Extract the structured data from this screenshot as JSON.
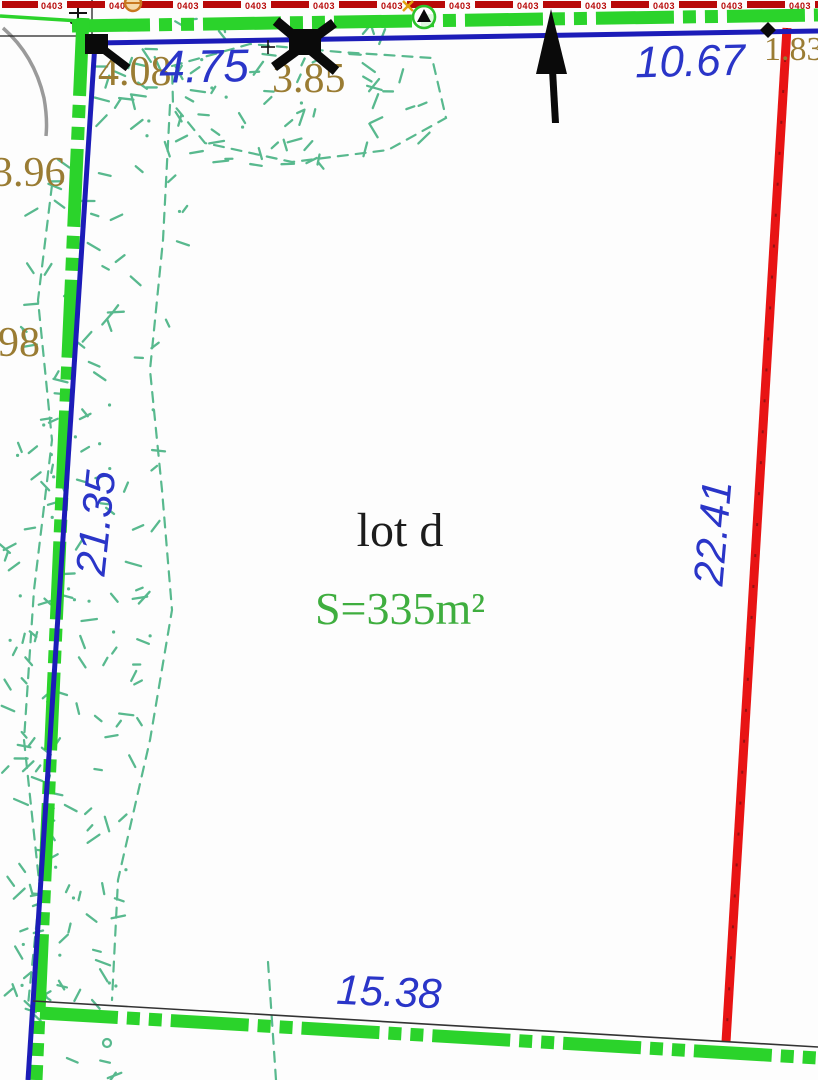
{
  "plan": {
    "lot_name": "lot d",
    "area": "S=335m²",
    "dimensions": {
      "top_west": "4.75",
      "top_east": "10.67",
      "west": "21.35",
      "east": "22.41",
      "south": "15.38"
    },
    "spot_values": {
      "nw": "4.08",
      "n": "3.85",
      "w_upper": "3.96",
      "w_lower": "98",
      "ne": "1.83"
    },
    "utility_line_label": "0403",
    "colors": {
      "boundary_blue": "#1c1cb8",
      "dimension_text_blue": "#2a35c8",
      "cadastral_green": "#2bd32b",
      "vegetation_teal": "#58b98e",
      "proposed_red": "#e81414",
      "utility_red": "#b80909",
      "spot_text_olive": "#9a7c33",
      "area_text_green": "#3fae3f",
      "lot_text": "#1c1c1c"
    }
  }
}
